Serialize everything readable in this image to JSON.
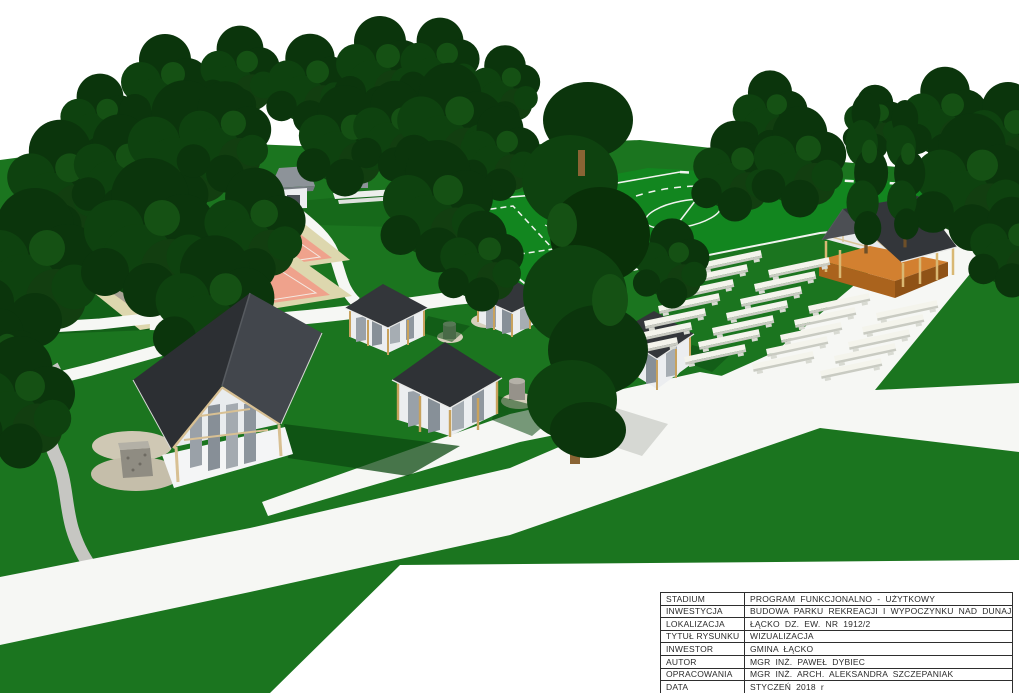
{
  "titleblock": {
    "rows": [
      {
        "label": "STADIUM",
        "value": "PROGRAM FUNKCJONALNO - UŻYTKOWY"
      },
      {
        "label": "INWESTYCJA",
        "value": "BUDOWA PARKU REKREACJI I WYPOCZYNKU NAD DUNAJCEM"
      },
      {
        "label": "LOKALIZACJA",
        "value": "ŁĄCKO DZ. EW. NR 1912/2"
      },
      {
        "label": "TYTUŁ RYSUNKU",
        "value": "WIZUALIZACJA"
      },
      {
        "label": "INWESTOR",
        "value": "GMINA ŁĄCKO"
      },
      {
        "label": "AUTOR",
        "value": "MGR INŻ. PAWEŁ DYBIEC"
      },
      {
        "label": "OPRACOWANIA",
        "value": "MGR INŻ. ARCH. ALEKSANDRA SZCZEPANIAK"
      },
      {
        "label": "DATA",
        "value": "STYCZEŃ 2018 r"
      }
    ]
  },
  "scene": {
    "features": [
      "lawn",
      "treeline",
      "football-field",
      "tennis-courts",
      "service-building",
      "hall-shelter",
      "picnic-gazebos",
      "performance-stage",
      "audience-benches",
      "stone-well",
      "fire-pits",
      "walking-paths",
      "gravel-path"
    ],
    "colors": {
      "sky": "#ffffff",
      "lawn": "#1b751f",
      "field_grass": "#12861f",
      "tree_dark": "#0b350c",
      "tree_mid": "#0e420f",
      "tree_light": "#155114",
      "path_white": "#f6f7f4",
      "path_gravel": "#c6c6c2",
      "court_pink": "#efa28c",
      "court_beige": "#ddd7ae",
      "roof_dark": "#33363a",
      "wood": "#c8a25d",
      "stage_wood": "#d28030",
      "bench_white": "#f4f4ec",
      "shadow_green": "#0c4a12"
    }
  }
}
